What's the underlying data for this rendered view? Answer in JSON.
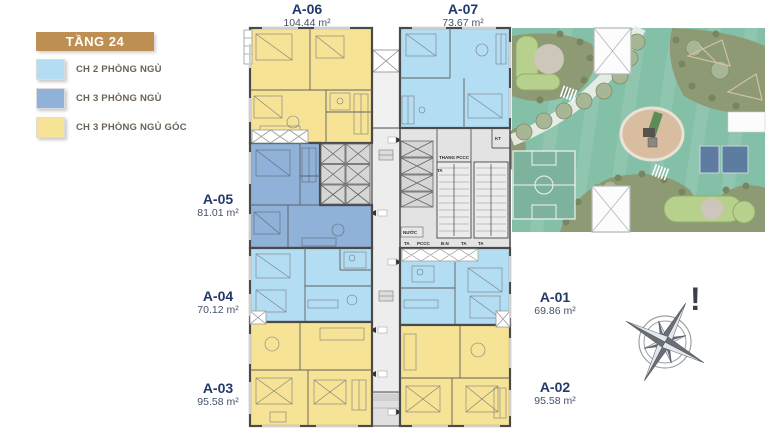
{
  "legend": {
    "title": "TẦNG 24",
    "title_bg": "#bd8f52",
    "items": [
      {
        "label": "CH 2 PHÒNG NGỦ",
        "color": "#b2ddf2"
      },
      {
        "label": "CH 3 PHÒNG NGỦ",
        "color": "#90b2d8"
      },
      {
        "label": "CH 3 PHÒNG NGỦ GÓC",
        "color": "#f7e395"
      }
    ]
  },
  "units": {
    "a01": {
      "name": "A-01",
      "area": "69.86 m²"
    },
    "a02": {
      "name": "A-02",
      "area": "95.58 m²"
    },
    "a03": {
      "name": "A-03",
      "area": "95.58 m²"
    },
    "a04": {
      "name": "A-04",
      "area": "70.12 m²"
    },
    "a05": {
      "name": "A-05",
      "area": "81.01 m²"
    },
    "a06": {
      "name": "A-06",
      "area": "104.44 m²"
    },
    "a07": {
      "name": "A-07",
      "area": "73.67 m²"
    }
  },
  "core": {
    "fire_stairs": "THANG PCCC",
    "ta": "TA",
    "kt": "KT",
    "water": "NƯỚC",
    "pccc": "PCCC",
    "dn": "Đ.N"
  },
  "compass": {
    "mark": "!"
  },
  "colors": {
    "wall": "#4a4a4a",
    "corridor": "#ededed",
    "core": "#e3e3e3",
    "elevator": "#d6d6d6",
    "garden_lawn": "#84bfa7",
    "garden_planting": "#8d9a74",
    "garden_playground": "#d8bda0",
    "garden_court": "#5d7da0"
  }
}
